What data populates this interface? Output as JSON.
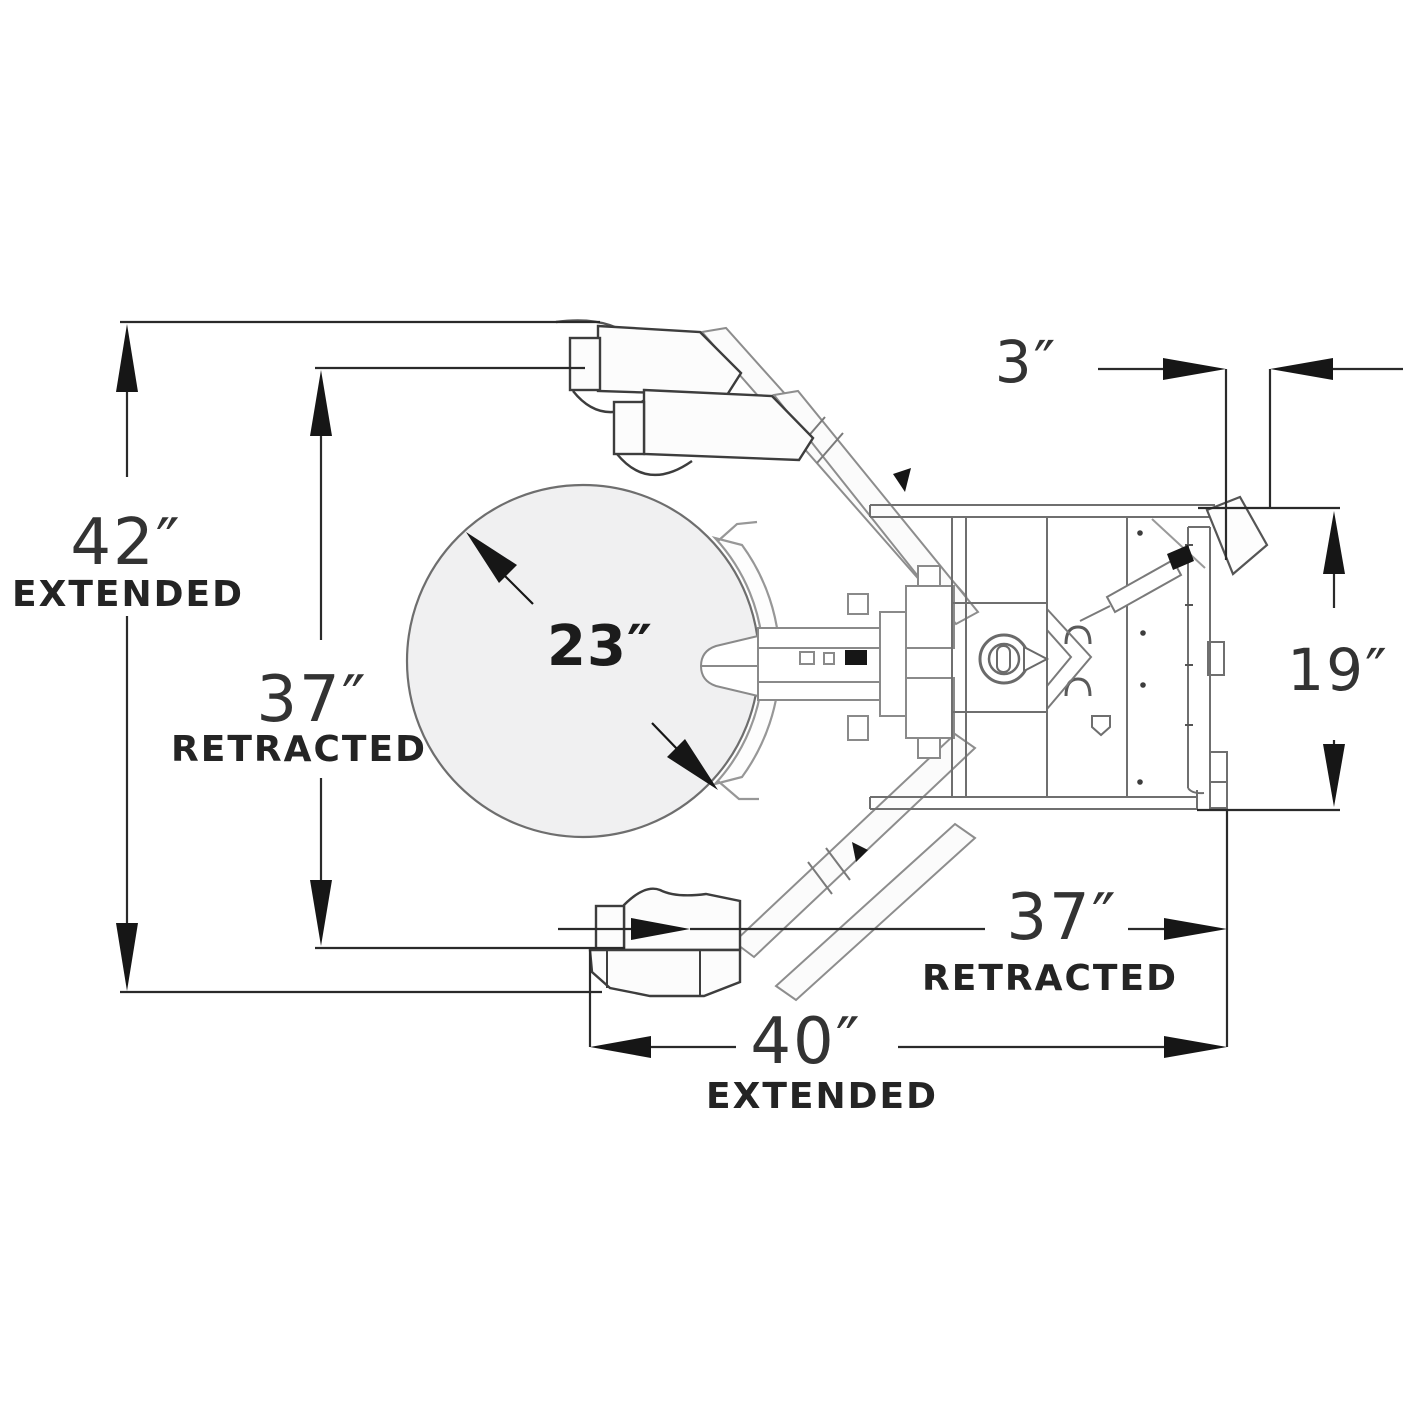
{
  "diagram": {
    "kind": "engineering-drawing",
    "subject": "drum grabber attachment - top plan view",
    "background_color": "#ffffff",
    "dimension_line_color": "#2a2a2a",
    "machine_line_color": "#8a8a8a",
    "drum_fill_color": "#f0f0f1"
  },
  "dims": {
    "left_extended": {
      "value": "42″",
      "label": "EXTENDED"
    },
    "left_retracted": {
      "value": "37″",
      "label": "RETRACTED"
    },
    "drum_diameter": {
      "value": "23″"
    },
    "top_gap": {
      "value": "3″"
    },
    "side_width": {
      "value": "19″"
    },
    "bottom_retracted": {
      "value": "37″",
      "label": "RETRACTED"
    },
    "bottom_extended": {
      "value": "40″",
      "label": "EXTENDED"
    }
  }
}
